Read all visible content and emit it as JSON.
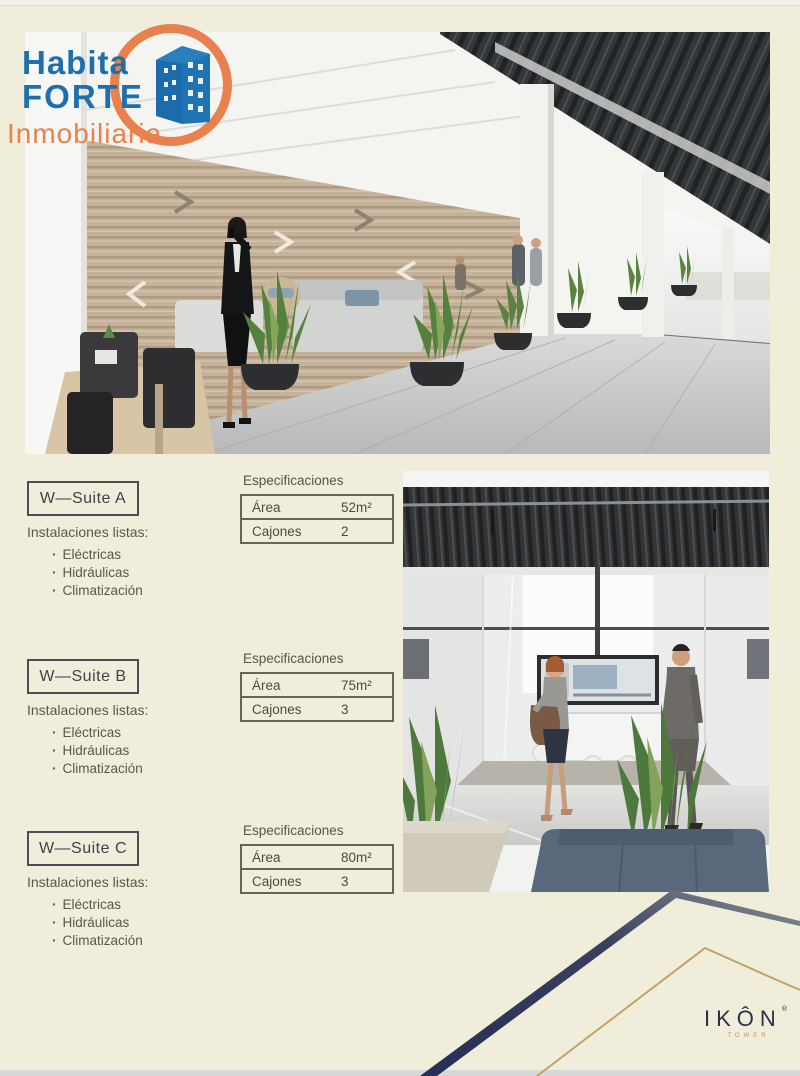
{
  "page": {
    "background_color": "#f0eedb",
    "description": "Real estate brochure page for IKÔN Tower office suites"
  },
  "logo": {
    "habita": "Habita",
    "forte": "FORTE",
    "inmobiliaria": "Inmobiliaria",
    "blue": "#1e6fad",
    "orange": "#e8814e"
  },
  "hero_image": {
    "label": "office-lounge-rendering"
  },
  "meeting_image": {
    "label": "meeting-room-rendering"
  },
  "suites": [
    {
      "name": "W—Suite A",
      "instalaciones_label": "Instalaciones listas:",
      "features": [
        "Eléctricas",
        "Hidráulicas",
        "Climatización"
      ],
      "spec_title": "Especificaciones",
      "area_label": "Área",
      "area_value": "52m²",
      "cajones_label": "Cajones",
      "cajones_value": "2"
    },
    {
      "name": "W—Suite B",
      "instalaciones_label": "Instalaciones listas:",
      "features": [
        "Eléctricas",
        "Hidráulicas",
        "Climatización"
      ],
      "spec_title": "Especificaciones",
      "area_label": "Área",
      "area_value": "75m²",
      "cajones_label": "Cajones",
      "cajones_value": "3"
    },
    {
      "name": "W—Suite C",
      "instalaciones_label": "Instalaciones listas:",
      "features": [
        "Eléctricas",
        "Hidráulicas",
        "Climatización"
      ],
      "spec_title": "Especificaciones",
      "area_label": "Área",
      "area_value": "80m²",
      "cajones_label": "Cajones",
      "cajones_value": "3"
    }
  ],
  "footer": {
    "brand": "IKÔN",
    "registered": "®",
    "brand_sub": "TOWER",
    "navy_line_color": "#2b3261",
    "tan_line_color": "#c3a06a",
    "brand_color": "#2c3049",
    "sub_color": "#c1915f"
  }
}
